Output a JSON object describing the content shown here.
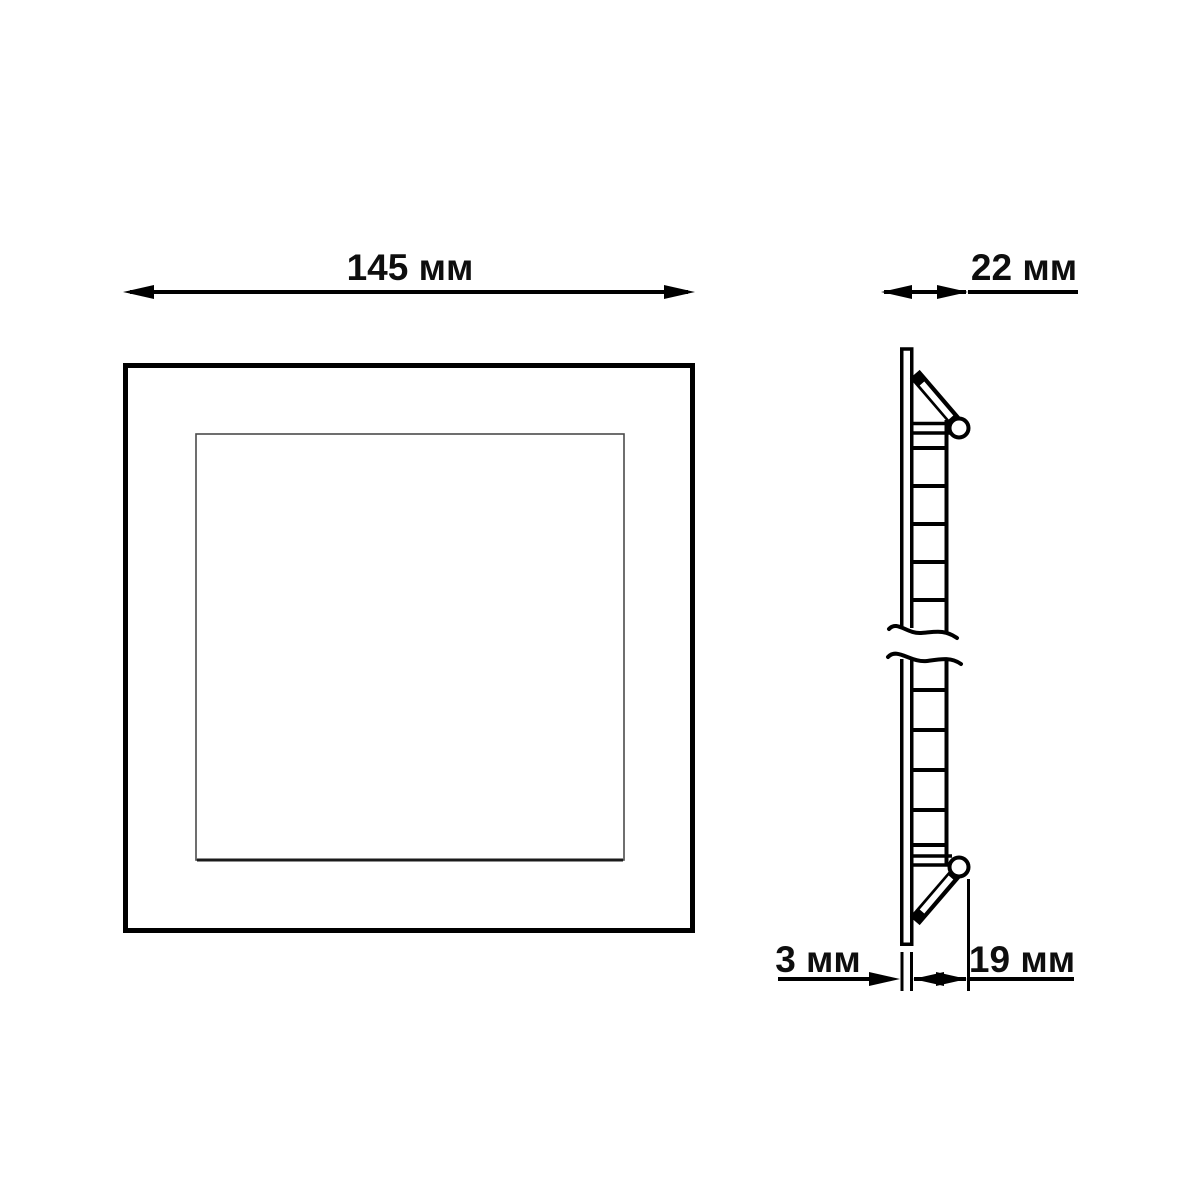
{
  "labels": {
    "width": "145 мм",
    "depth": "22 мм",
    "flange": "3 мм",
    "recess": "19 мм"
  },
  "dimensions": [
    {
      "name": "overall-width",
      "value": 145,
      "unit": "мм",
      "label": "145 мм"
    },
    {
      "name": "overall-depth",
      "value": 22,
      "unit": "мм",
      "label": "22 мм"
    },
    {
      "name": "flange-thickness",
      "value": 3,
      "unit": "мм",
      "label": "3 мм"
    },
    {
      "name": "recess-depth",
      "value": 19,
      "unit": "мм",
      "label": "19 мм"
    }
  ],
  "colors": {
    "line": "#000000",
    "inner_square_line": "#4b4b4b",
    "background": "#ffffff",
    "text": "#0e0e0e"
  }
}
